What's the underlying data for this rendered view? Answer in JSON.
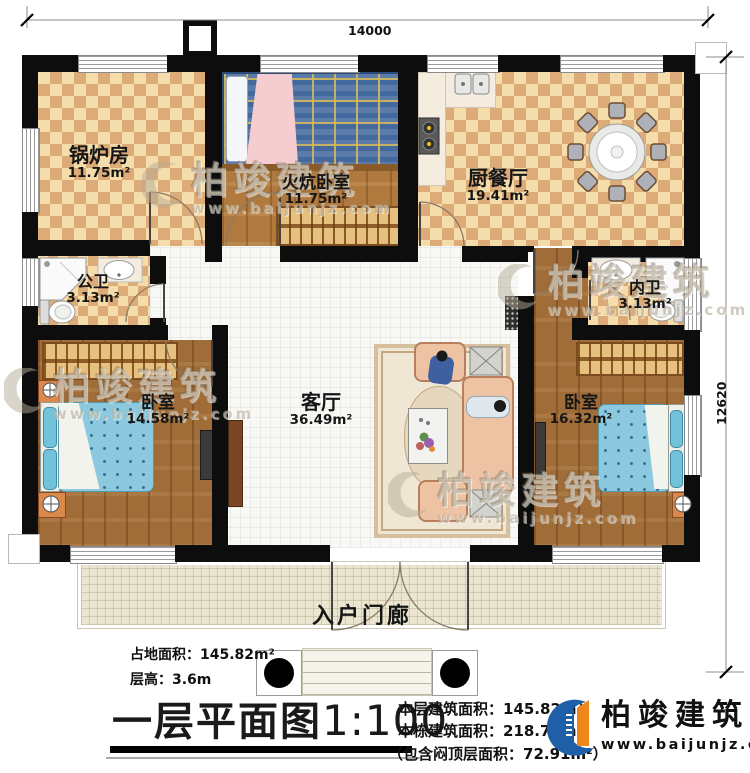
{
  "dimensions": {
    "width_label": "14000",
    "height_label": "12620"
  },
  "rooms": {
    "boiler": {
      "name": "锅炉房",
      "area": "11.75m²"
    },
    "kang_bedroom": {
      "name": "火炕卧室",
      "area": "11.75m²"
    },
    "kitchen_dining": {
      "name": "厨餐厅",
      "area": "19.41m²"
    },
    "public_bath": {
      "name": "公卫",
      "area": "3.13m²"
    },
    "inner_bath": {
      "name": "内卫",
      "area": "3.13m²"
    },
    "bedroom_left": {
      "name": "卧室",
      "area": "14.58m²"
    },
    "living_room": {
      "name": "客厅",
      "area": "36.49m²"
    },
    "bedroom_right": {
      "name": "卧室",
      "area": "16.32m²"
    },
    "porch": {
      "name": "入户门廊"
    }
  },
  "info_left": {
    "site_area": "占地面积：145.82m²",
    "floor_height": "层高：3.6m"
  },
  "title": {
    "plan_name": "一层平面图",
    "scale": "1:100"
  },
  "info_right": {
    "floor_area": "本层建筑面积：145.82m²",
    "building_area": "本栋建筑面积：218.73m²",
    "attic_note": "（包含闷顶层面积：72.91m²）"
  },
  "brand": {
    "name": "柏竣建筑",
    "website": "www.baijunjz.com"
  },
  "watermark": {
    "name": "柏竣建筑",
    "website": "www.baijunjz.com"
  },
  "colors": {
    "wall": "#0d0d0d",
    "brand_blue": "#1f5fa8",
    "brand_orange": "#f08519"
  }
}
